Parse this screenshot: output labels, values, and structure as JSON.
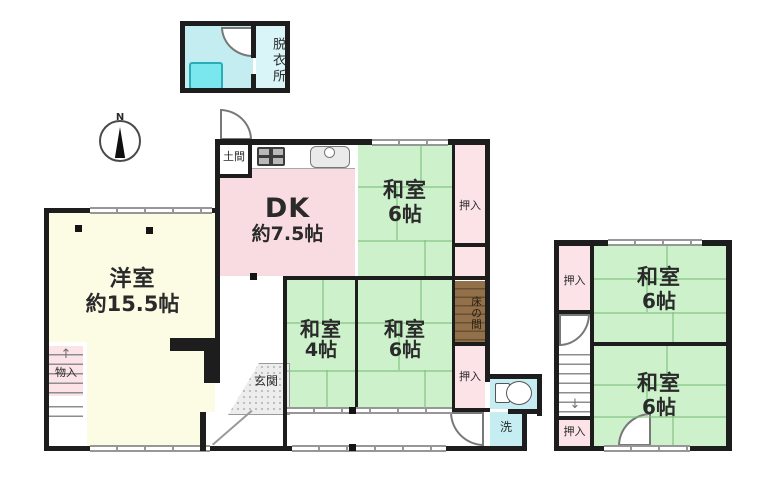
{
  "plan": {
    "compass": {
      "north": "N"
    },
    "bath": {
      "dressing_room": "脱衣所"
    },
    "rooms": {
      "dk": {
        "name": "DK",
        "size": "約7.5帖"
      },
      "western": {
        "name": "洋室",
        "size": "約15.5帖"
      },
      "washitsu_ne": {
        "name": "和室",
        "size": "6帖"
      },
      "washitsu_4": {
        "name": "和室",
        "size": "4帖"
      },
      "washitsu_mid": {
        "name": "和室",
        "size": "6帖"
      },
      "annex_north": {
        "name": "和室",
        "size": "6帖"
      },
      "annex_south": {
        "name": "和室",
        "size": "6帖"
      }
    },
    "features": {
      "doma": "土間",
      "genkan": "玄関",
      "monoire": "物入",
      "tokonoma": "床の間",
      "laundry": "洗",
      "oshiire_ne": "押入",
      "oshiire_mid": "押入",
      "annex_oshiire_north": "押入",
      "annex_oshiire_south": "押入"
    },
    "icons": {
      "arrow_up": "↑",
      "arrow_down": "↓"
    },
    "colors": {
      "tatami_green": "#cdf2cb",
      "dk_pink": "#f9dce1",
      "closet_pink": "#fbe3e7",
      "western_cream": "#fcfbe4",
      "water_cyan": "#c6eef2",
      "tub_cyan": "#7ae7ee",
      "tokonoma_brown": "#92714a",
      "wall_black": "#1d1d1d"
    }
  }
}
